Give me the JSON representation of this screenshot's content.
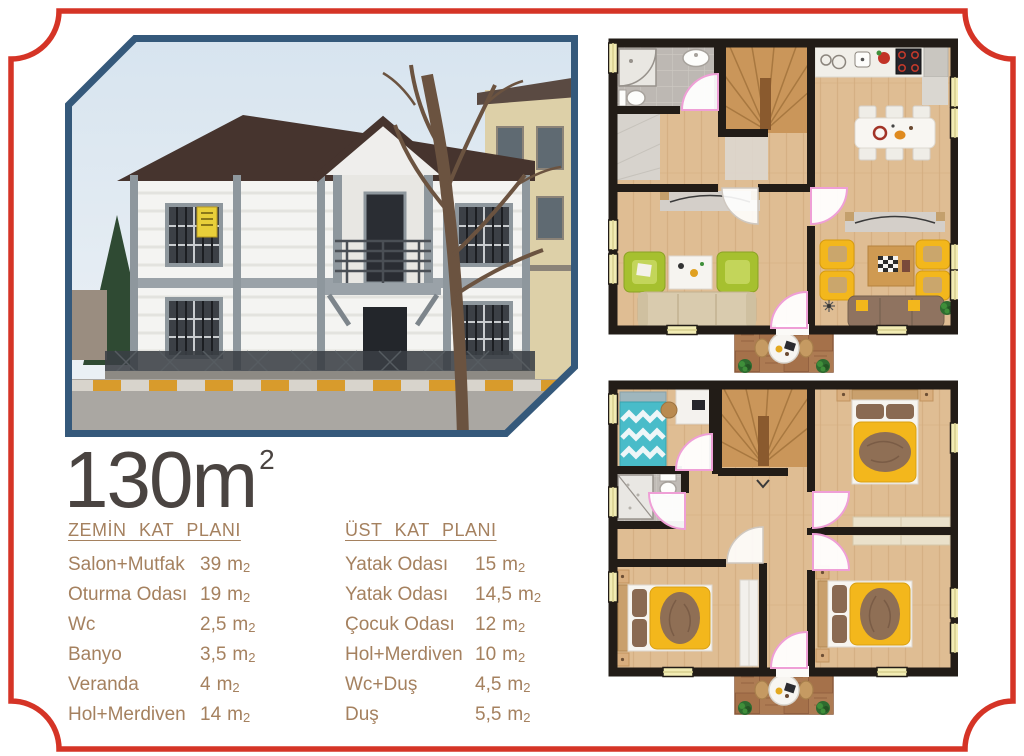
{
  "headline": {
    "value": "130",
    "unit_base": "m",
    "unit_exp": "2"
  },
  "units": {
    "base": "m",
    "exp": "2"
  },
  "ground_floor": {
    "title": "ZEMİN KAT PLANI",
    "rows": [
      {
        "label": "Salon+Mutfak",
        "value": "39"
      },
      {
        "label": "Oturma Odası",
        "value": "19"
      },
      {
        "label": "Wc",
        "value": "2,5"
      },
      {
        "label": "Banyo",
        "value": "3,5"
      },
      {
        "label": "Veranda",
        "value": "4"
      },
      {
        "label": "Hol+Merdiven",
        "value": "14"
      }
    ]
  },
  "upper_floor": {
    "title": "ÜST KAT PLANI",
    "rows": [
      {
        "label": "Yatak Odası",
        "value": "15"
      },
      {
        "label": "Yatak Odası",
        "value": "14,5"
      },
      {
        "label": "Çocuk Odası",
        "value": "12"
      },
      {
        "label": "Hol+Merdiven",
        "value": "10"
      },
      {
        "label": "Wc+Duş",
        "value": "4,5"
      },
      {
        "label": "Duş",
        "value": "5,5"
      }
    ]
  },
  "colors": {
    "frame_red": "#d53426",
    "photo_border_navy": "#35597b",
    "headline_gray": "#4a4441",
    "text_brown": "#a5815f",
    "plan_wall": "#221c17",
    "plan_floor_wood": "#dfbd93",
    "furniture_yellow": "#f3b71c",
    "furniture_green": "#a6c02f",
    "furniture_teal": "#49bcc9",
    "sofa_beige": "#d9cbae",
    "sofa_brown": "#8f7360",
    "door_arc_pink": "#ef9fd6",
    "window_yellow": "#f2ecb4",
    "veranda_deck": "#a5714a"
  }
}
